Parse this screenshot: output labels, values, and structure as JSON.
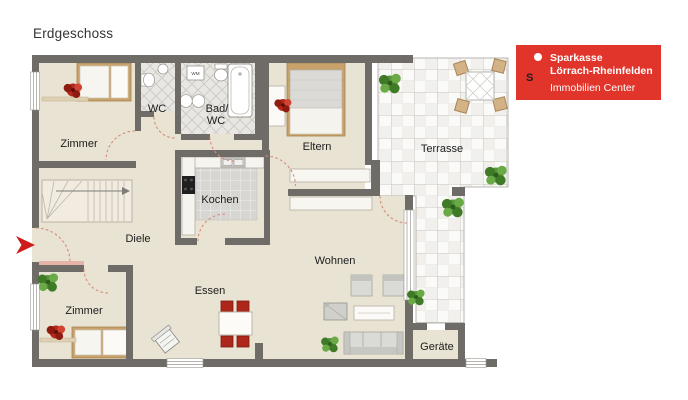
{
  "title": "Erdgeschoss",
  "logo": {
    "brand": "Sparkasse",
    "region": "Lörrach-Rheinfelden",
    "department": "Immobilien Center",
    "glyph": "S"
  },
  "rooms": {
    "zimmer_top": "Zimmer",
    "wc": "WC",
    "bad_line1": "Bad/",
    "bad_line2": "WC",
    "eltern": "Eltern",
    "terrasse": "Terrasse",
    "kochen": "Kochen",
    "diele": "Diele",
    "zimmer_bottom": "Zimmer",
    "essen": "Essen",
    "wohnen": "Wohnen",
    "geraete": "Geräte"
  },
  "appliances": {
    "washing_machine": "WM"
  },
  "colors": {
    "wall": "#6f6b66",
    "floor": "#e9e3d3",
    "logo_red": "#e1352b",
    "chair_red": "#ad271b",
    "door_arc": "#d98b78",
    "plant_green": "#4e8f2f",
    "plant_red": "#b5281b",
    "entry_arrow": "#cc1c1c"
  }
}
